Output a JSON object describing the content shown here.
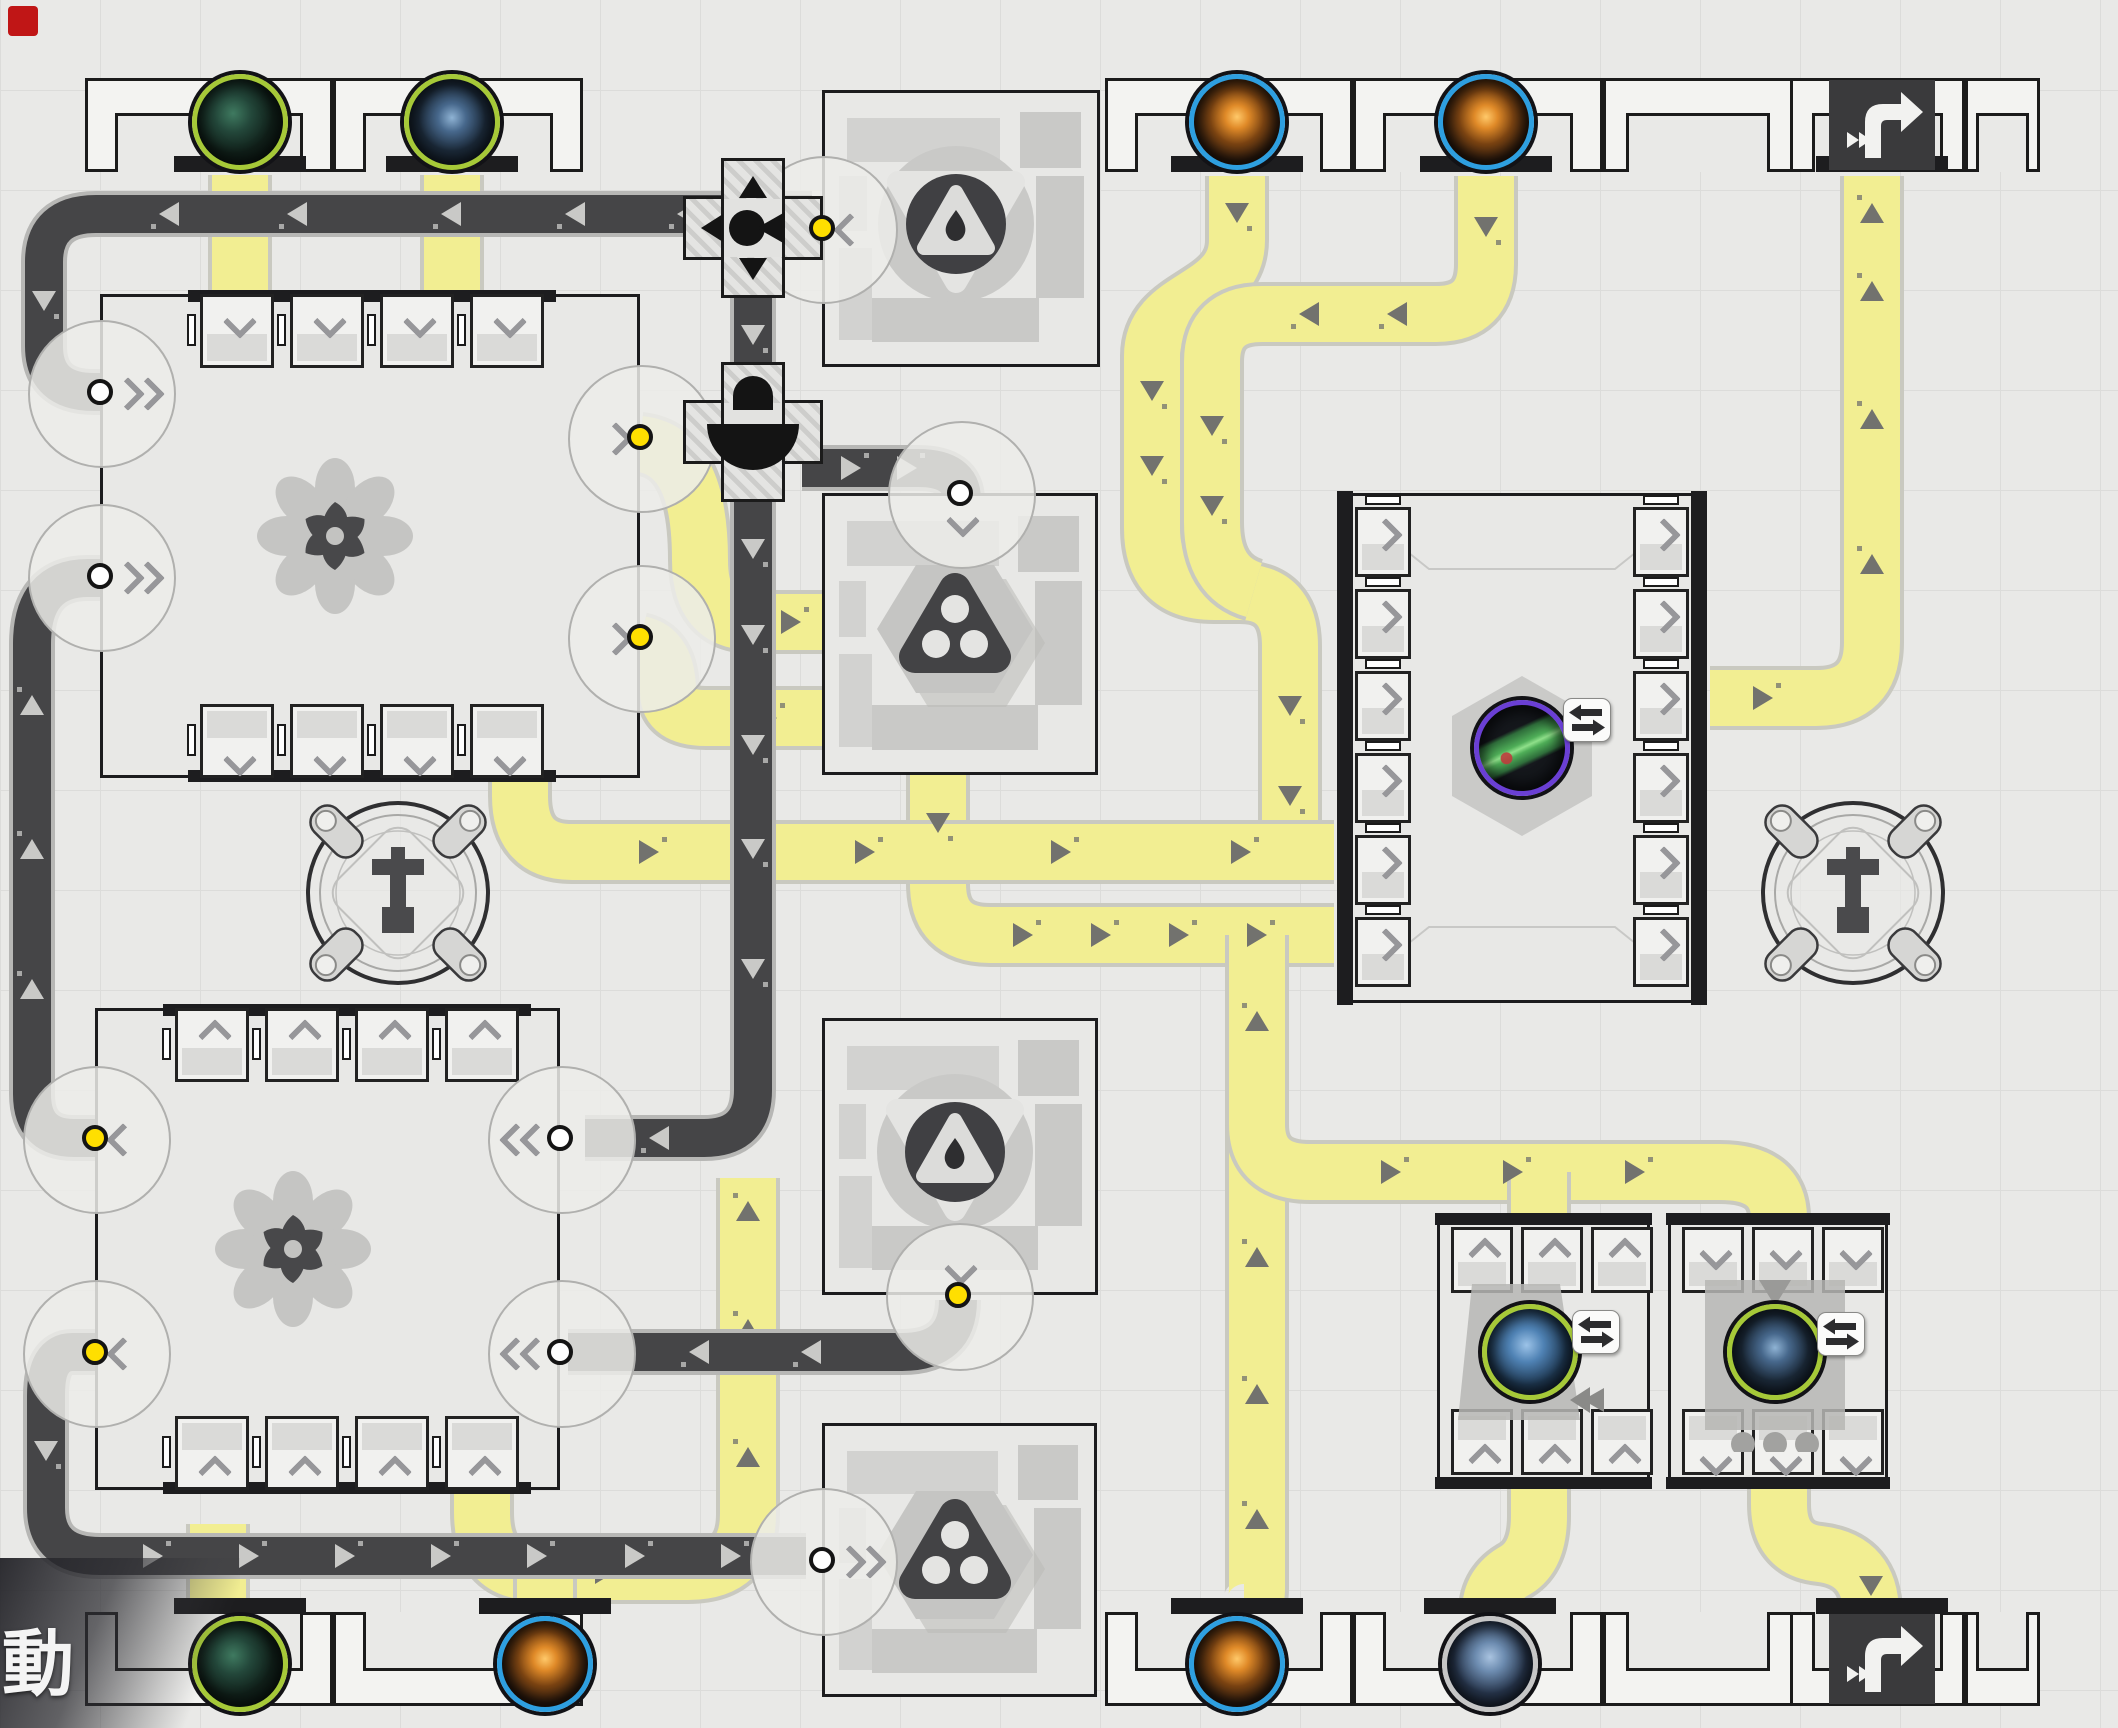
{
  "hud": {
    "action_label": "動"
  },
  "theme": {
    "background": "#e9e9e7",
    "grid_line": "#dcdcda",
    "belt_yellow": "#f2ee92",
    "belt_yellow_edge": "#c9c9c0",
    "belt_yellow_arrow": "#72726e",
    "belt_dark": "#454547",
    "belt_dark_edge": "#b7b7b5",
    "belt_dark_arrow": "#c9c9c7",
    "machine_border": "#1c1c1e",
    "accent_yellow_dot": "#ffdf00",
    "ring_green": "#a6c938",
    "ring_blue": "#2e9fe0",
    "ring_silver": "#c6c6c6",
    "ring_purple": "#6a3fd4",
    "marker_red": "#c01616"
  },
  "belts": {
    "yellow": [
      {
        "path": "M240,175 L240,298",
        "arrows": []
      },
      {
        "path": "M452,175 L452,298",
        "arrows": []
      },
      {
        "path": "M1237,176 L1237,240 C1237,302 1152,294 1152,356 L1152,528 Q1152,592 1214,592 L1240,592 Q1290,592 1290,646 L1290,852",
        "arrows": [
          [
            1237,
            212,
            90
          ],
          [
            1152,
            390,
            90
          ],
          [
            1152,
            465,
            90
          ],
          [
            1290,
            705,
            90
          ],
          [
            1290,
            795,
            90
          ]
        ]
      },
      {
        "path": "M1486,176 L1486,264 Q1486,314 1436,314 L1262,314 Q1212,314 1212,362 L1212,522 Q1212,578 1254,590",
        "arrows": [
          [
            1486,
            226,
            90
          ],
          [
            1398,
            314,
            180
          ],
          [
            1310,
            314,
            180
          ],
          [
            1212,
            425,
            90
          ],
          [
            1212,
            505,
            90
          ]
        ]
      },
      {
        "path": "M640,444 Q700,450 700,560 Q700,622 752,622 L886,622 Q938,622 938,674 L938,884 Q938,935 990,935 L1334,935",
        "arrows": [
          [
            790,
            622,
            0
          ],
          [
            862,
            622,
            0
          ],
          [
            938,
            712,
            90
          ],
          [
            938,
            822,
            90
          ],
          [
            1022,
            935,
            0
          ],
          [
            1100,
            935,
            0
          ],
          [
            1178,
            935,
            0
          ],
          [
            1256,
            935,
            0
          ]
        ]
      },
      {
        "path": "M640,644 Q668,650 668,692 Q668,718 706,718 L884,718 Q930,718 936,752",
        "arrows": [
          [
            766,
            718,
            0
          ],
          [
            842,
            718,
            0
          ]
        ]
      },
      {
        "path": "M520,778 L520,796 Q520,852 572,852 L1334,852",
        "arrows": [
          [
            648,
            852,
            0
          ],
          [
            864,
            852,
            0
          ],
          [
            1060,
            852,
            0
          ],
          [
            1240,
            852,
            0
          ]
        ]
      },
      {
        "path": "M1257,935 L1257,1588 Q1257,1612 1244,1612",
        "arrows": [
          [
            1257,
            1022,
            270
          ],
          [
            1257,
            1258,
            270
          ],
          [
            1257,
            1395,
            270
          ],
          [
            1257,
            1520,
            270
          ]
        ]
      },
      {
        "path": "M1257,1124 Q1257,1172 1310,1172 L1720,1172 Q1779,1172 1779,1218",
        "arrows": [
          [
            1390,
            1172,
            0
          ],
          [
            1512,
            1172,
            0
          ],
          [
            1634,
            1172,
            0
          ]
        ]
      },
      {
        "path": "M1539,1172 L1539,1218",
        "arrows": []
      },
      {
        "path": "M1539,1486 L1539,1516 Q1539,1556 1516,1570 Q1490,1584 1490,1612",
        "arrows": []
      },
      {
        "path": "M1779,1486 L1779,1504 Q1779,1550 1820,1554 Q1871,1560 1871,1614",
        "arrows": [
          [
            1871,
            1585,
            90
          ]
        ]
      },
      {
        "path": "M1710,698 L1816,698 Q1872,698 1872,642 L1872,176",
        "arrows": [
          [
            1762,
            698,
            0
          ],
          [
            1872,
            565,
            270
          ],
          [
            1872,
            420,
            270
          ],
          [
            1872,
            292,
            270
          ],
          [
            1872,
            214,
            270
          ]
        ]
      },
      {
        "path": "M218,1610 L218,1524",
        "arrows": []
      },
      {
        "path": "M482,1490 L482,1512 Q482,1572 534,1572 L688,1572 Q748,1572 748,1514 L748,1178",
        "arrows": [
          [
            604,
            1572,
            0
          ],
          [
            748,
            1458,
            270
          ],
          [
            748,
            1330,
            270
          ],
          [
            748,
            1212,
            270
          ]
        ]
      },
      {
        "path": "M545,1610 L545,1574",
        "arrows": []
      }
    ],
    "dark": [
      {
        "path": "M812,214 L96,214 Q44,214 44,262 L44,346 Q44,392 94,392 L106,392",
        "arrows": [
          [
            688,
            214,
            180
          ],
          [
            576,
            214,
            180
          ],
          [
            452,
            214,
            180
          ],
          [
            298,
            214,
            180
          ],
          [
            170,
            214,
            180
          ],
          [
            44,
            300,
            90
          ]
        ]
      },
      {
        "path": "M97,1138 L74,1138 Q32,1138 32,1094 L32,644 Q32,578 88,578 L106,578",
        "arrows": [
          [
            32,
            990,
            270
          ],
          [
            32,
            850,
            270
          ],
          [
            32,
            706,
            270
          ]
        ]
      },
      {
        "path": "M97,1352 L72,1352 Q46,1352 46,1396 L46,1508 Q46,1556 100,1556 L806,1556",
        "arrows": [
          [
            46,
            1450,
            90
          ],
          [
            152,
            1556,
            0
          ],
          [
            248,
            1556,
            0
          ],
          [
            344,
            1556,
            0
          ],
          [
            440,
            1556,
            0
          ],
          [
            536,
            1556,
            0
          ],
          [
            634,
            1556,
            0
          ],
          [
            730,
            1556,
            0
          ]
        ]
      },
      {
        "path": "M753,276 L753,384",
        "arrows": [
          [
            753,
            334,
            90
          ]
        ]
      },
      {
        "path": "M753,482 L753,1090 Q753,1138 704,1138 L585,1138",
        "arrows": [
          [
            753,
            548,
            90
          ],
          [
            753,
            634,
            90
          ],
          [
            753,
            744,
            90
          ],
          [
            753,
            848,
            90
          ],
          [
            753,
            968,
            90
          ],
          [
            660,
            1138,
            180
          ]
        ]
      },
      {
        "path": "M802,468 L918,468 Q962,468 962,500",
        "arrows": [
          [
            850,
            468,
            0
          ],
          [
            906,
            468,
            0
          ]
        ]
      },
      {
        "path": "M958,1300 Q958,1352 902,1352 L568,1352",
        "arrows": [
          [
            812,
            1352,
            180
          ],
          [
            700,
            1352,
            180
          ]
        ]
      }
    ]
  },
  "walls": {
    "top": {
      "y": 78,
      "h": 94,
      "bar_y": 156,
      "orb_y": 74,
      "modules": [
        [
          85,
          248
        ],
        [
          333,
          250
        ],
        [
          1105,
          248
        ],
        [
          1353,
          250
        ],
        [
          1603,
          190
        ],
        [
          1790,
          175
        ],
        [
          1965,
          75
        ]
      ],
      "orbs": [
        {
          "x": 240,
          "type": "green-crystal",
          "name": "ore-port-green-crystal"
        },
        {
          "x": 452,
          "type": "blue-rock",
          "name": "ore-port-blue-rock"
        },
        {
          "x": 1237,
          "type": "orange-cube",
          "name": "ore-port-orange-cube"
        },
        {
          "x": 1486,
          "type": "orange-cube",
          "name": "ore-port-orange-cube"
        }
      ],
      "doors": [
        {
          "x": 1882,
          "name": "delivery-door-port"
        }
      ]
    },
    "bottom": {
      "y": 1612,
      "h": 94,
      "bar_y": 1598,
      "orb_y": 1616,
      "modules": [
        [
          85,
          248
        ],
        [
          333,
          250
        ],
        [
          1105,
          248
        ],
        [
          1353,
          250
        ],
        [
          1603,
          190
        ],
        [
          1790,
          175
        ],
        [
          1965,
          75
        ]
      ],
      "orbs": [
        {
          "x": 240,
          "type": "green-crystal",
          "name": "ore-port-green-crystal"
        },
        {
          "x": 545,
          "type": "orange-cube",
          "name": "ore-port-orange-cube"
        },
        {
          "x": 1237,
          "type": "orange-cube",
          "name": "ore-port-orange-cube"
        },
        {
          "x": 1490,
          "type": "blue-tower",
          "name": "ore-port-blue-tower"
        }
      ],
      "doors": [
        {
          "x": 1882,
          "name": "delivery-door-port"
        }
      ]
    }
  },
  "processors": [
    {
      "name": "processor-upper",
      "x": 100,
      "y": 294,
      "w": 540,
      "h": 484,
      "slot_xs": [
        200,
        290,
        380,
        470
      ],
      "rows": [
        {
          "y": 294,
          "pos": "top",
          "dir": "down"
        },
        {
          "y": 704,
          "pos": "bottom",
          "dir": "down"
        }
      ],
      "ports": [
        {
          "side": "left",
          "y": 392,
          "dot": "white",
          "dir": "right",
          "double": true
        },
        {
          "side": "left",
          "y": 576,
          "dot": "white",
          "dir": "right",
          "double": true
        },
        {
          "side": "right",
          "y": 437,
          "dot": "yellow",
          "dir": "right",
          "double": false
        },
        {
          "side": "right",
          "y": 637,
          "dot": "yellow",
          "dir": "right",
          "double": false
        }
      ],
      "icon": "pinwheel"
    },
    {
      "name": "processor-lower",
      "x": 95,
      "y": 1008,
      "w": 465,
      "h": 482,
      "slot_xs": [
        175,
        265,
        355,
        445
      ],
      "rows": [
        {
          "y": 1008,
          "pos": "top",
          "dir": "up"
        },
        {
          "y": 1416,
          "pos": "bottom",
          "dir": "up"
        }
      ],
      "ports": [
        {
          "side": "left",
          "y": 1138,
          "dot": "yellow",
          "dir": "left",
          "double": false
        },
        {
          "side": "left",
          "y": 1352,
          "dot": "yellow",
          "dir": "left",
          "double": false
        },
        {
          "side": "right",
          "y": 1138,
          "dot": "white",
          "dir": "left",
          "double": true
        },
        {
          "side": "right",
          "y": 1352,
          "dot": "white",
          "dir": "left",
          "double": true
        }
      ],
      "icon": "pinwheel"
    }
  ],
  "refineries": [
    {
      "name": "refinery-upper",
      "x": 822,
      "y": 90,
      "w": 278,
      "h": 277,
      "icon": "tri-drop",
      "ports": [
        {
          "side": "left",
          "y": 228,
          "dot": "yellow",
          "dir": "left",
          "double": false
        }
      ]
    },
    {
      "name": "combiner-upper",
      "x": 822,
      "y": 493,
      "w": 276,
      "h": 282,
      "icon": "hex-knot",
      "ports": [
        {
          "side": "top",
          "x": 960,
          "dot": "white",
          "dir": "down",
          "double": false
        }
      ]
    },
    {
      "name": "refinery-lower",
      "x": 822,
      "y": 1018,
      "w": 276,
      "h": 277,
      "icon": "tri-drop",
      "ports": [
        {
          "side": "bottom",
          "x": 958,
          "dot": "yellow",
          "dir": "down",
          "double": false
        }
      ]
    },
    {
      "name": "combiner-lower",
      "x": 822,
      "y": 1423,
      "w": 275,
      "h": 274,
      "icon": "hex-knot",
      "ports": [
        {
          "side": "left",
          "y": 1560,
          "dot": "white",
          "dir": "right",
          "double": true
        }
      ]
    }
  ],
  "assembler": {
    "name": "assembler",
    "x": 1337,
    "y": 493,
    "w": 370,
    "h": 510,
    "slots_per_side": 6,
    "item": {
      "x": 1522,
      "y": 748,
      "type": "circuit",
      "ring": "purple",
      "name": "product-item"
    },
    "badge": {
      "x": 1563,
      "y": 698
    }
  },
  "duplicators": [
    {
      "name": "duplicator-left",
      "x": 1437,
      "y": 1215,
      "w": 213,
      "h": 272,
      "chev": "up",
      "orb": {
        "x": 1530,
        "y": 1352,
        "type": "blue-crystal"
      },
      "badge": {
        "x": 1572,
        "y": 1310
      },
      "sil": "tower"
    },
    {
      "name": "duplicator-right",
      "x": 1668,
      "y": 1215,
      "w": 220,
      "h": 272,
      "chev": "down",
      "orb": {
        "x": 1775,
        "y": 1352,
        "type": "blue-rock"
      },
      "badge": {
        "x": 1817,
        "y": 1312
      },
      "sil": "dots"
    }
  ],
  "presses": [
    {
      "x": 398,
      "y": 893,
      "name": "press-station"
    },
    {
      "x": 1853,
      "y": 893,
      "name": "press-station"
    }
  ],
  "splitters": [
    {
      "x": 753,
      "y": 228,
      "variant": "cross-arrows",
      "name": "belt-splitter"
    },
    {
      "x": 753,
      "y": 432,
      "variant": "bridge",
      "name": "belt-bridge"
    }
  ],
  "marker": {
    "x": 8,
    "y": 6,
    "w": 30,
    "h": 30
  }
}
